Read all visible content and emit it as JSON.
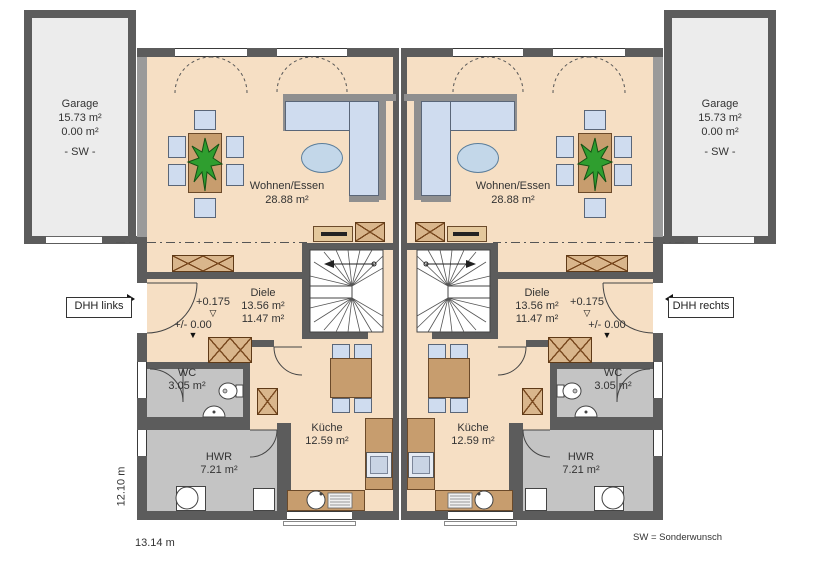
{
  "garage": {
    "name": "Garage",
    "garage_area": "15.73 m²",
    "living_area": "0.00 m²",
    "note": "- SW -"
  },
  "units": {
    "left": {
      "label": "DHH links"
    },
    "right": {
      "label": "DHH rechts"
    }
  },
  "rooms": {
    "living": {
      "name": "Wohnen/Essen",
      "area": "28.88 m²"
    },
    "hall": {
      "name": "Diele",
      "area_a": "13.56 m²",
      "area_b": "11.47 m²"
    },
    "wc": {
      "name": "WC",
      "area": "3.05 m²"
    },
    "utility": {
      "name": "HWR",
      "area": "7.21 m²"
    },
    "kitchen": {
      "name": "Küche",
      "area": "12.59 m²"
    }
  },
  "levels": {
    "upper_floor": "+0.175",
    "upper_marker": "▽",
    "ground_floor": "+/- 0.00",
    "ground_marker": "▼"
  },
  "dimensions": {
    "total_width": "13.14 m",
    "total_depth": "12.10 m"
  },
  "legend": {
    "sw_note": "SW = Sonderwunsch"
  },
  "colors": {
    "floor": "#f6dfc4",
    "wall": "#5c5c5c",
    "wet_room_floor": "#c4c4c4",
    "garage_floor": "#ececec",
    "furniture_wood": "#c79d6e",
    "upholstery": "#cfdcef",
    "plant": "#2f9e2f"
  }
}
